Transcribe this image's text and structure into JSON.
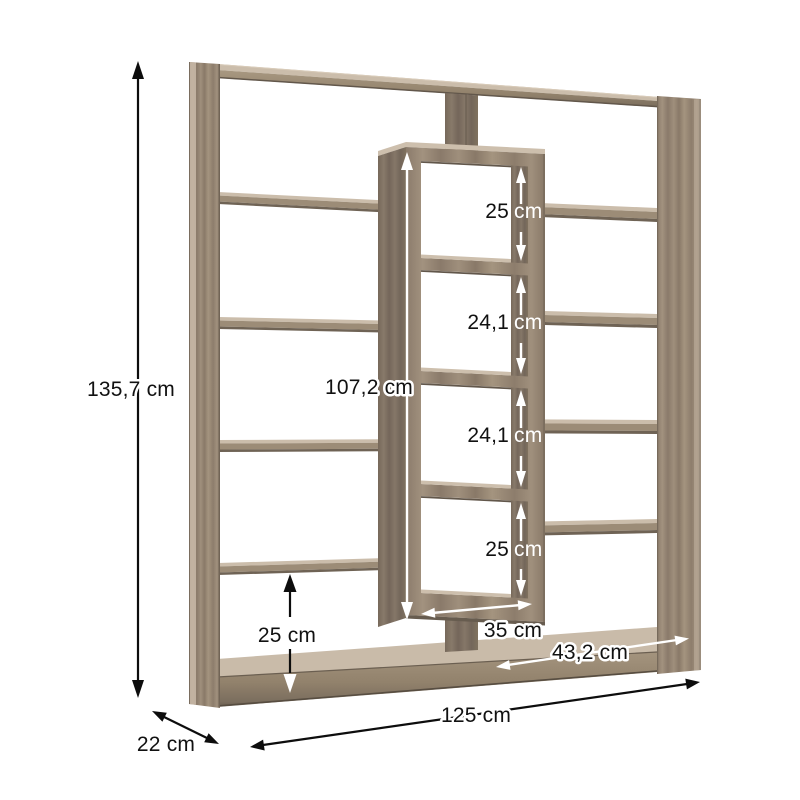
{
  "page": {
    "background": "#ffffff"
  },
  "diagram": {
    "subject": "bookcase-with-staggered-shelves-dimension-diagram",
    "annotations": {
      "overall_height": "135,7 cm",
      "overall_width": "125 cm",
      "overall_depth": "22 cm",
      "middle_column_height": "107,2 cm",
      "middle_column_width": "35 cm",
      "bottom_left_compartment_height": "25 cm",
      "bottom_right_compartment_width": "43,2 cm",
      "middle_column_compartments": [
        {
          "value": "25",
          "unit": "cm"
        },
        {
          "value": "24,1",
          "unit": "cm"
        },
        {
          "value": "24,1",
          "unit": "cm"
        },
        {
          "value": "25",
          "unit": "cm"
        }
      ]
    },
    "colors": {
      "wood_mid": "#9c8c77",
      "wood_light": "#cbbdab",
      "wood_dark": "#6f6355",
      "wood_side": "#80725f",
      "arrow_black": "#0d0d0d",
      "arrow_white": "#ffffff",
      "background": "#ffffff"
    }
  }
}
